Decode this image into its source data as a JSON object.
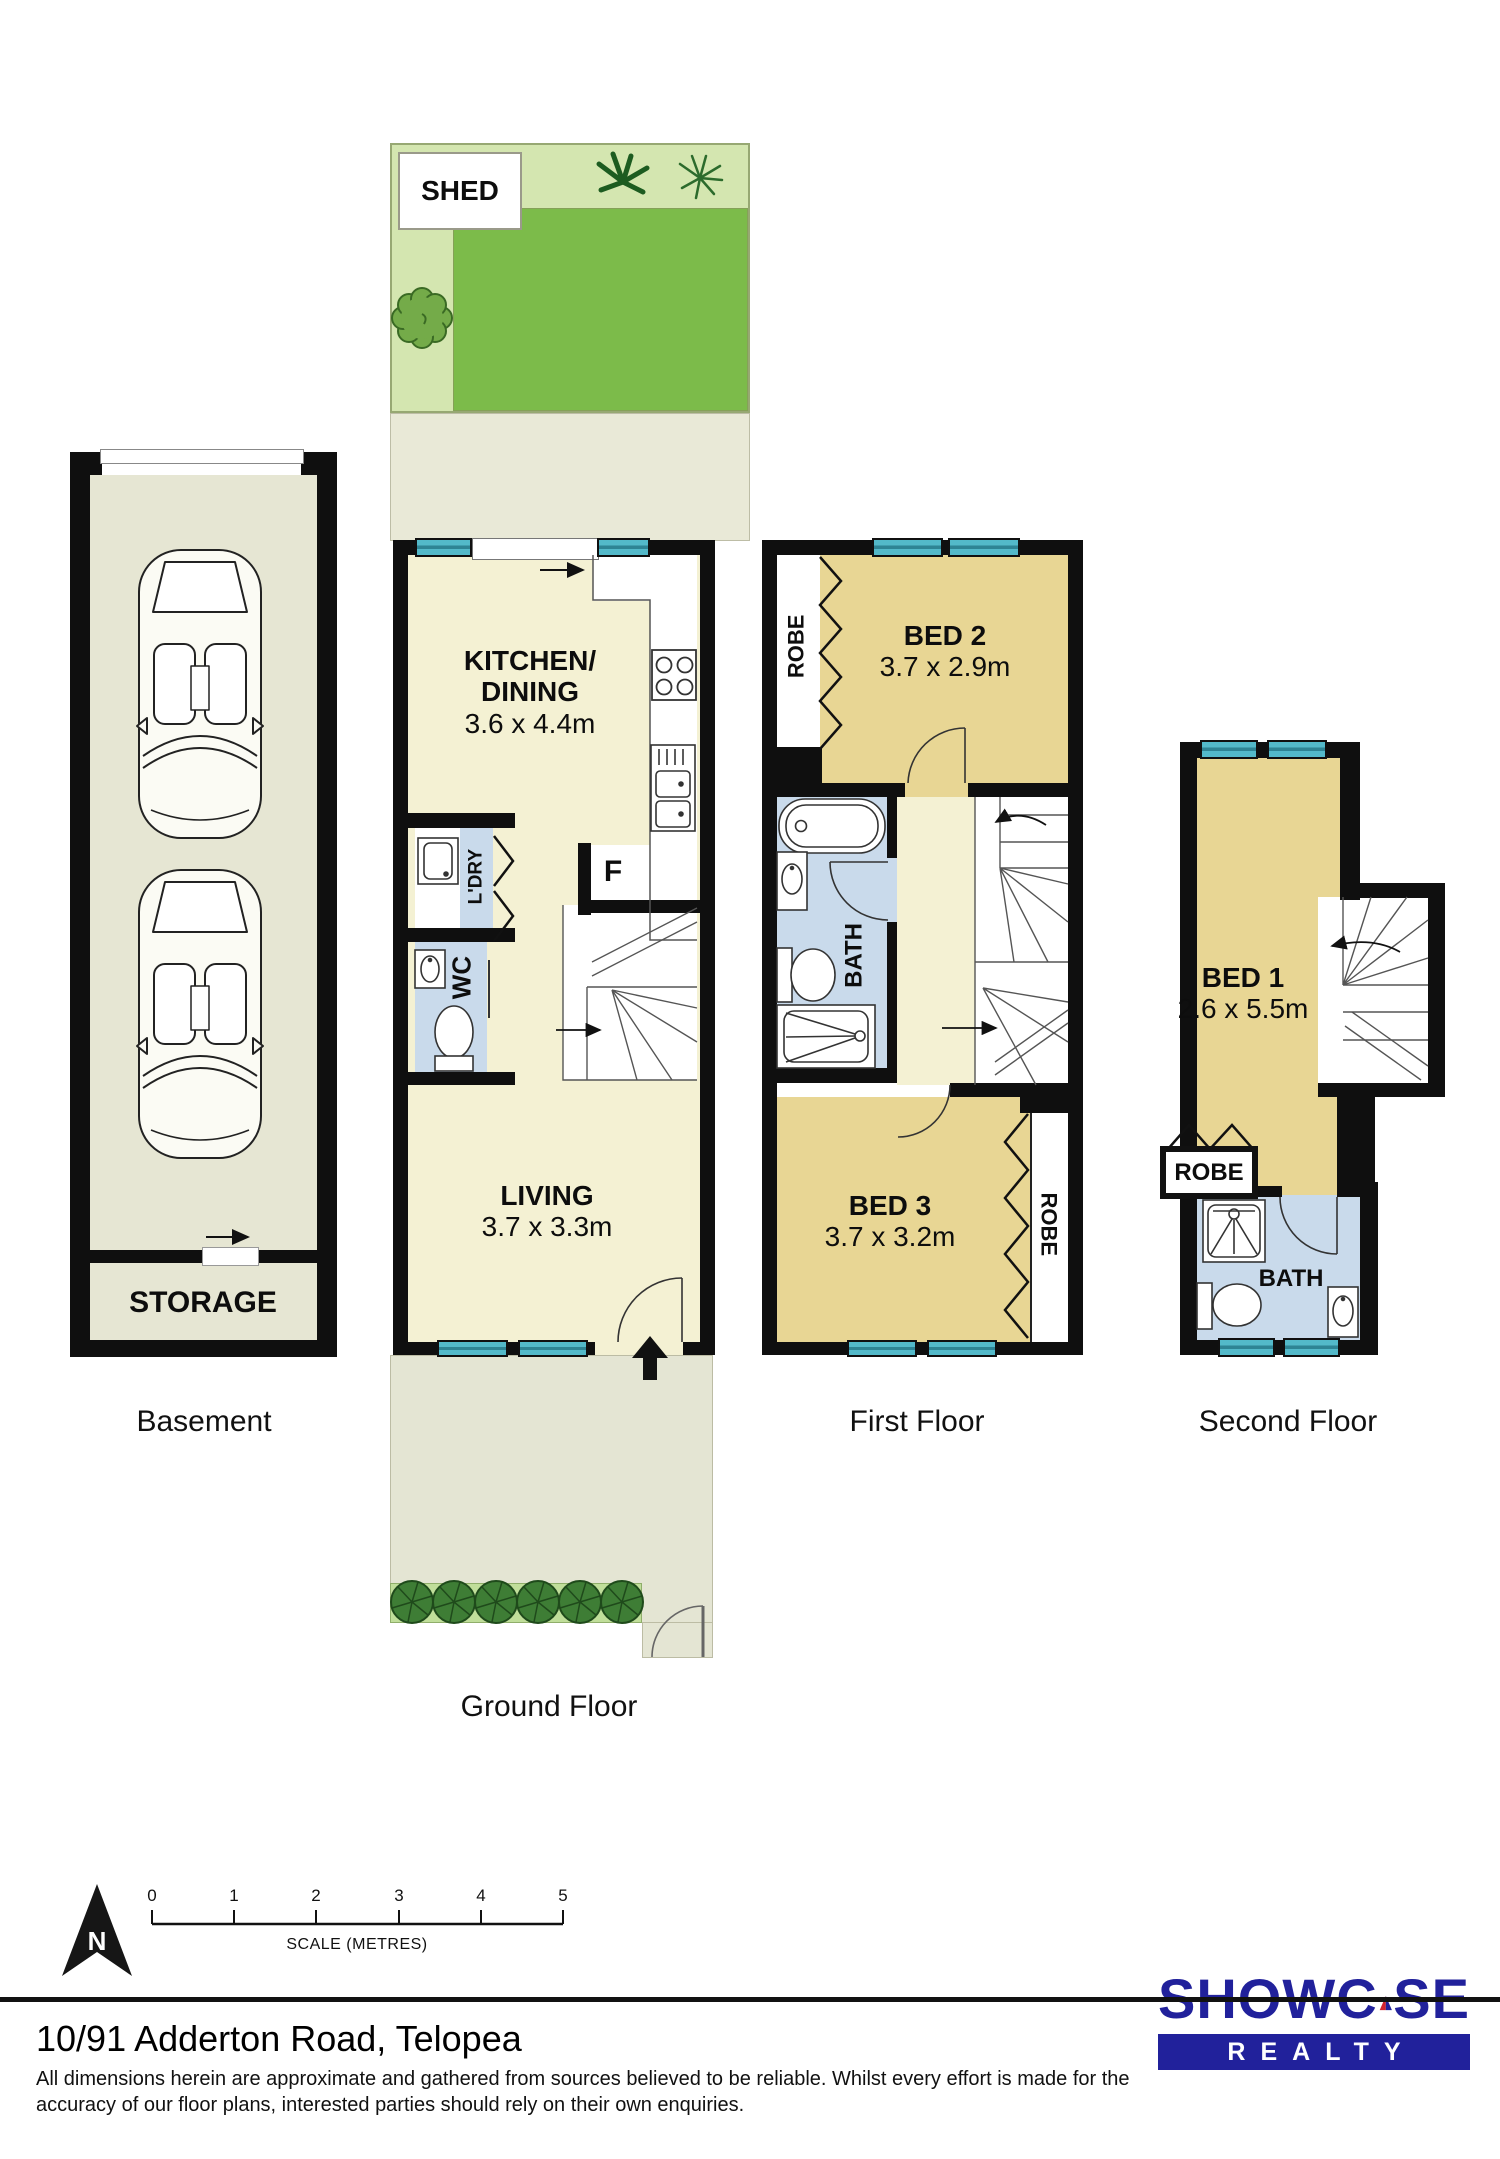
{
  "plans": {
    "basement": {
      "caption": "Basement",
      "storage": "STORAGE"
    },
    "ground_floor": {
      "caption": "Ground Floor",
      "shed": "SHED",
      "kitchen_line1": "KITCHEN/",
      "kitchen_line2": "DINING",
      "kitchen_dims": "3.6 x 4.4m",
      "living": "LIVING",
      "living_dims": "3.7 x 3.3m",
      "laundry": "L'DRY",
      "wc": "WC",
      "fridge": "F"
    },
    "first_floor": {
      "caption": "First Floor",
      "bed2": "BED 2",
      "bed2_dims": "3.7 x 2.9m",
      "bed3": "BED 3",
      "bed3_dims": "3.7 x 3.2m",
      "bath": "BATH",
      "robe_bed2": "ROBE",
      "robe_bed3": "ROBE"
    },
    "second_floor": {
      "caption": "Second Floor",
      "bed1": "BED 1",
      "bed1_dims": "2.6 x 5.5m",
      "robe": "ROBE",
      "bath": "BATH"
    }
  },
  "scale": {
    "north": "N",
    "ticks": [
      "0",
      "1",
      "2",
      "3",
      "4",
      "5"
    ],
    "label": "SCALE (METRES)"
  },
  "logo": {
    "word_start": "SHOWC",
    "word_end": "SE",
    "realty": "REALTY"
  },
  "footer": {
    "address": "10/91 Adderton Road, Telopea",
    "disclaimer_line1": "All dimensions herein are approximate and gathered from sources believed to be reliable. Whilst every effort is made for the",
    "disclaimer_line2": "accuracy of our floor plans, interested parties should rely on their own enquiries."
  },
  "colors": {
    "wall": "#0f0f0f",
    "floor_cream": "#f4f1d3",
    "floor_tan": "#e8d694",
    "floor_blue": "#c9daeb",
    "window_teal": "#53b9c9",
    "lawn_green": "#7cbb4a",
    "garden_light": "#d4e6b0",
    "logo_navy": "#21219b",
    "logo_red": "#d2232e"
  }
}
